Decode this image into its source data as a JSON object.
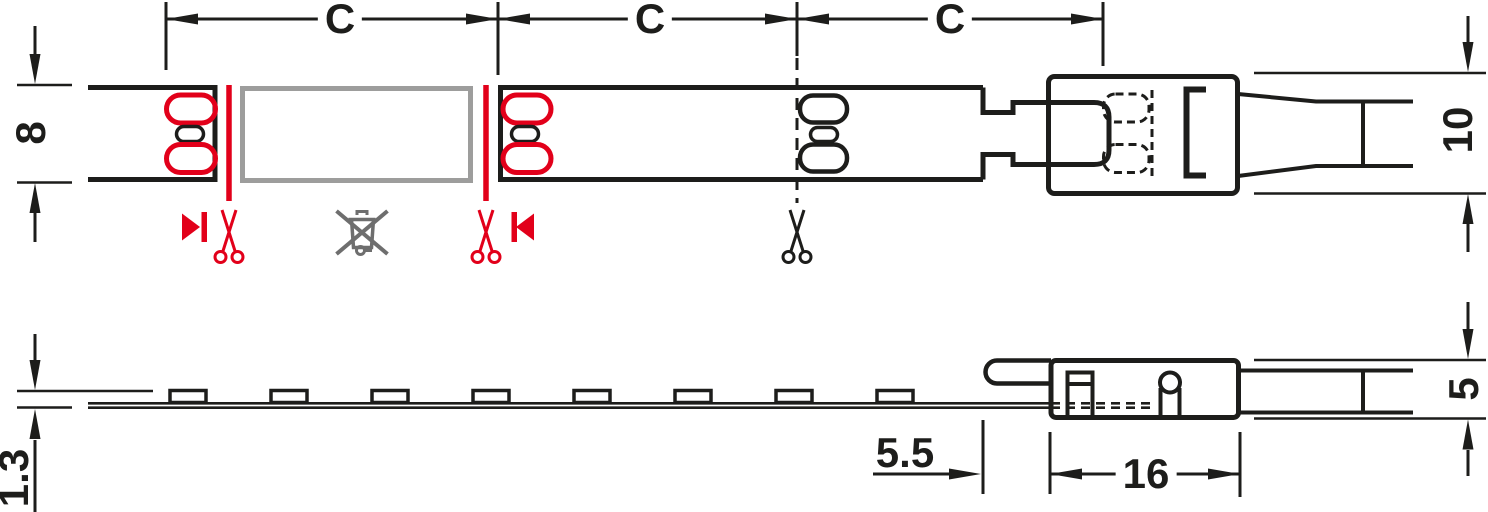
{
  "drawing": {
    "kind": "LED flexible strip light – dimensioned technical drawing (top view and side view)",
    "views": [
      "top-view",
      "side-view"
    ]
  },
  "dimensions": {
    "c1": "C",
    "c2": "C",
    "c3": "C",
    "strip_width_mm": "8",
    "connector_width_mm": "10",
    "tape_height_mm": "1.3",
    "connector_lead_mm": "5.5",
    "connector_length_mm": "16",
    "connector_height_mm": "5"
  },
  "colors": {
    "black": "#1d1d1b",
    "red": "#e2001a",
    "gray": "#9d9d9c",
    "icon_gray": "#6e6e6e"
  }
}
